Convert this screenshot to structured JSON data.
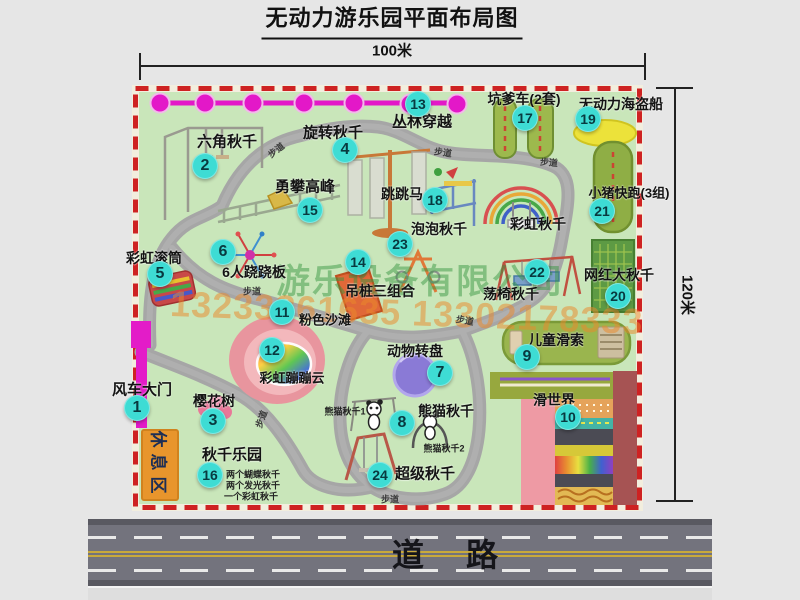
{
  "title": "无动力游乐园平面布局图",
  "dimensions": {
    "width_label": "100米",
    "height_label": "120米"
  },
  "road": {
    "label": "道路"
  },
  "watermark": {
    "company": "游乐设备有限公司",
    "phone": "13233861635 13302178333"
  },
  "colors": {
    "background": "#e6e6e6",
    "park_green": "#c9e6ba",
    "border_red": "#ce2222",
    "path_gray": "#a6a6a6",
    "badge_teal": "#3edcd4",
    "gate_magenta": "#e31cc8",
    "jungle_magenta": "#e318c8",
    "rest_orange": "#e8952c",
    "sand_pink": "#e8959e",
    "carousel_purple": "#8a7ad6",
    "road_gray": "#73737d",
    "lane_yellow": "#c9a93c"
  },
  "park": {
    "rest_area_label": "休息区",
    "path_label_text": "步道",
    "attractions": [
      {
        "num": "1",
        "label": "风车大门",
        "bx": 137,
        "by": 408,
        "lx": 142,
        "ly": 389,
        "fs": 15
      },
      {
        "num": "2",
        "label": "六角秋千",
        "bx": 205,
        "by": 166,
        "lx": 227,
        "ly": 141,
        "fs": 15
      },
      {
        "num": "3",
        "label": "樱花树",
        "bx": 213,
        "by": 421,
        "lx": 214,
        "ly": 401,
        "fs": 14
      },
      {
        "num": "4",
        "label": "旋转秋千",
        "bx": 345,
        "by": 150,
        "lx": 333,
        "ly": 132,
        "fs": 15
      },
      {
        "num": "5",
        "label": "彩虹滚筒",
        "bx": 160,
        "by": 274,
        "lx": 154,
        "ly": 258,
        "fs": 14
      },
      {
        "num": "6",
        "label": "6人跷跷板",
        "bx": 223,
        "by": 252,
        "lx": 254,
        "ly": 272,
        "fs": 14
      },
      {
        "num": "7",
        "label": "动物转盘",
        "bx": 440,
        "by": 373,
        "lx": 415,
        "ly": 351,
        "fs": 14
      },
      {
        "num": "8",
        "label": "熊猫秋千",
        "bx": 402,
        "by": 423,
        "lx": 446,
        "ly": 411,
        "fs": 14
      },
      {
        "num": "9",
        "label": "儿童滑索",
        "bx": 527,
        "by": 357,
        "lx": 556,
        "ly": 340,
        "fs": 14
      },
      {
        "num": "10",
        "label": "滑世界",
        "bx": 568,
        "by": 417,
        "lx": 554,
        "ly": 400,
        "fs": 14
      },
      {
        "num": "11",
        "label": "粉色沙滩",
        "bx": 282,
        "by": 312,
        "lx": 325,
        "ly": 319,
        "fs": 13
      },
      {
        "num": "12",
        "label": "彩虹蹦蹦云",
        "bx": 272,
        "by": 350,
        "lx": 292,
        "ly": 377,
        "fs": 13
      },
      {
        "num": "13",
        "label": "丛林穿越",
        "bx": 418,
        "by": 104,
        "lx": 422,
        "ly": 121,
        "fs": 15
      },
      {
        "num": "14",
        "label": "吊桩三组合",
        "bx": 358,
        "by": 262,
        "lx": 380,
        "ly": 291,
        "fs": 14
      },
      {
        "num": "15",
        "label": "勇攀高峰",
        "bx": 310,
        "by": 210,
        "lx": 305,
        "ly": 186,
        "fs": 15
      },
      {
        "num": "16",
        "label": "秋千乐园",
        "bx": 210,
        "by": 475,
        "lx": 232,
        "ly": 454,
        "fs": 15
      },
      {
        "num": "17",
        "label": "坑爹车(2套)",
        "bx": 525,
        "by": 118,
        "lx": 524,
        "ly": 99,
        "fs": 14
      },
      {
        "num": "18",
        "label": "跳跳马",
        "bx": 435,
        "by": 200,
        "lx": 402,
        "ly": 194,
        "fs": 14
      },
      {
        "num": "19",
        "label": "无动力海盗船",
        "bx": 588,
        "by": 119,
        "lx": 621,
        "ly": 104,
        "fs": 14
      },
      {
        "num": "20",
        "label": "网红大秋千",
        "bx": 618,
        "by": 296,
        "lx": 619,
        "ly": 275,
        "fs": 14
      },
      {
        "num": "21",
        "label": "小猪快跑(3组)",
        "bx": 602,
        "by": 211,
        "lx": 629,
        "ly": 192,
        "fs": 13
      },
      {
        "num": "22",
        "label": "荡椅秋千",
        "bx": 537,
        "by": 272,
        "lx": 511,
        "ly": 294,
        "fs": 14
      },
      {
        "num": "23",
        "label": "泡泡秋千",
        "bx": 400,
        "by": 244,
        "lx": 439,
        "ly": 229,
        "fs": 14
      },
      {
        "num": "24",
        "label": "超级秋千",
        "bx": 380,
        "by": 475,
        "lx": 425,
        "ly": 473,
        "fs": 15
      }
    ],
    "extra_labels": [
      {
        "text": "彩虹秋千",
        "x": 538,
        "y": 224,
        "fs": 14
      }
    ],
    "sub_labels": [
      {
        "text": "熊猫秋千1",
        "x": 345,
        "y": 411,
        "fs": 9
      },
      {
        "text": "熊猫秋千2",
        "x": 444,
        "y": 448,
        "fs": 9
      },
      {
        "text": "两个蝴蝶秋千",
        "x": 253,
        "y": 474,
        "fs": 9
      },
      {
        "text": "两个发光秋千",
        "x": 253,
        "y": 485,
        "fs": 9
      },
      {
        "text": "一个彩虹秋千",
        "x": 251,
        "y": 496,
        "fs": 9
      }
    ],
    "path_labels": [
      {
        "x": 276,
        "y": 150,
        "r": -38
      },
      {
        "x": 443,
        "y": 152,
        "r": 8
      },
      {
        "x": 549,
        "y": 162,
        "r": 5
      },
      {
        "x": 252,
        "y": 291,
        "r": 0
      },
      {
        "x": 261,
        "y": 419,
        "r": -70
      },
      {
        "x": 465,
        "y": 320,
        "r": 10
      },
      {
        "x": 390,
        "y": 499,
        "r": 0
      }
    ]
  }
}
